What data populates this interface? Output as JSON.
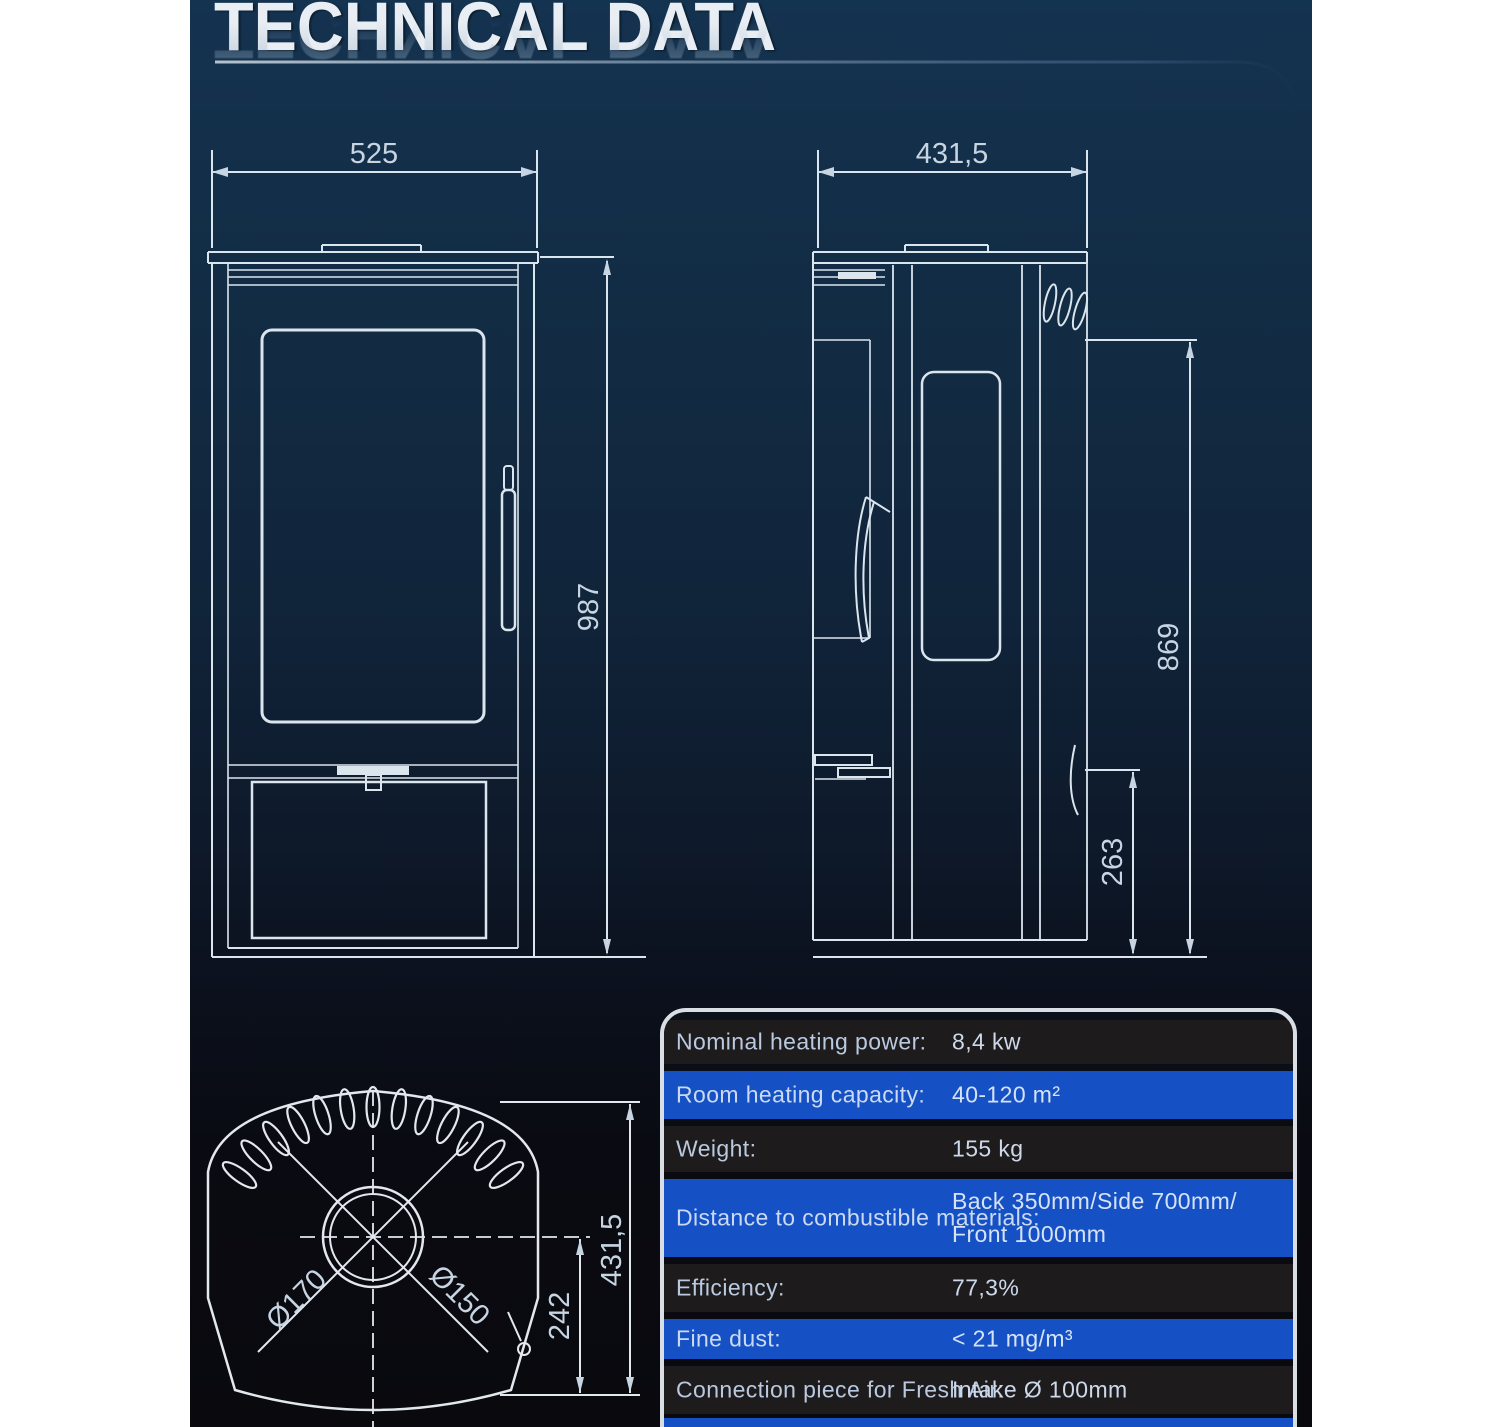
{
  "header": {
    "title": "TECHNICAL DATA"
  },
  "front_view": {
    "width_mm": "525",
    "height_mm": "987"
  },
  "side_view": {
    "depth_mm": "431,5",
    "upper_height_mm": "869",
    "lower_height_mm": "263"
  },
  "top_view": {
    "outer_diameter": "Ø170",
    "flue_diameter": "Ø150",
    "flue_offset_mm": "242",
    "depth_mm": "431,5"
  },
  "spec_table": {
    "rows": [
      {
        "label": "Nominal heating power:",
        "value": "8,4 kw"
      },
      {
        "label": "Room heating capacity:",
        "value": "40-120 m²"
      },
      {
        "label": "Weight:",
        "value": "155 kg"
      },
      {
        "label": "Distance to combustible materials:",
        "value": "Back 350mm/Side 700mm/",
        "value2": "Front 1000mm"
      },
      {
        "label": "Efficiency:",
        "value": "77,3%"
      },
      {
        "label": "Fine dust:",
        "value": "< 21 mg/m³"
      },
      {
        "label": "Connection piece for Fresh Air:",
        "value": "Intake Ø 100mm"
      }
    ]
  },
  "colors": {
    "background_top": "#143350",
    "background_bottom": "#09090e",
    "accent_row_blue": "#1551c4",
    "dark_row": "#1e1b1c",
    "drawing_line": "#dbe5ee",
    "title_text": "#e9eef4"
  }
}
